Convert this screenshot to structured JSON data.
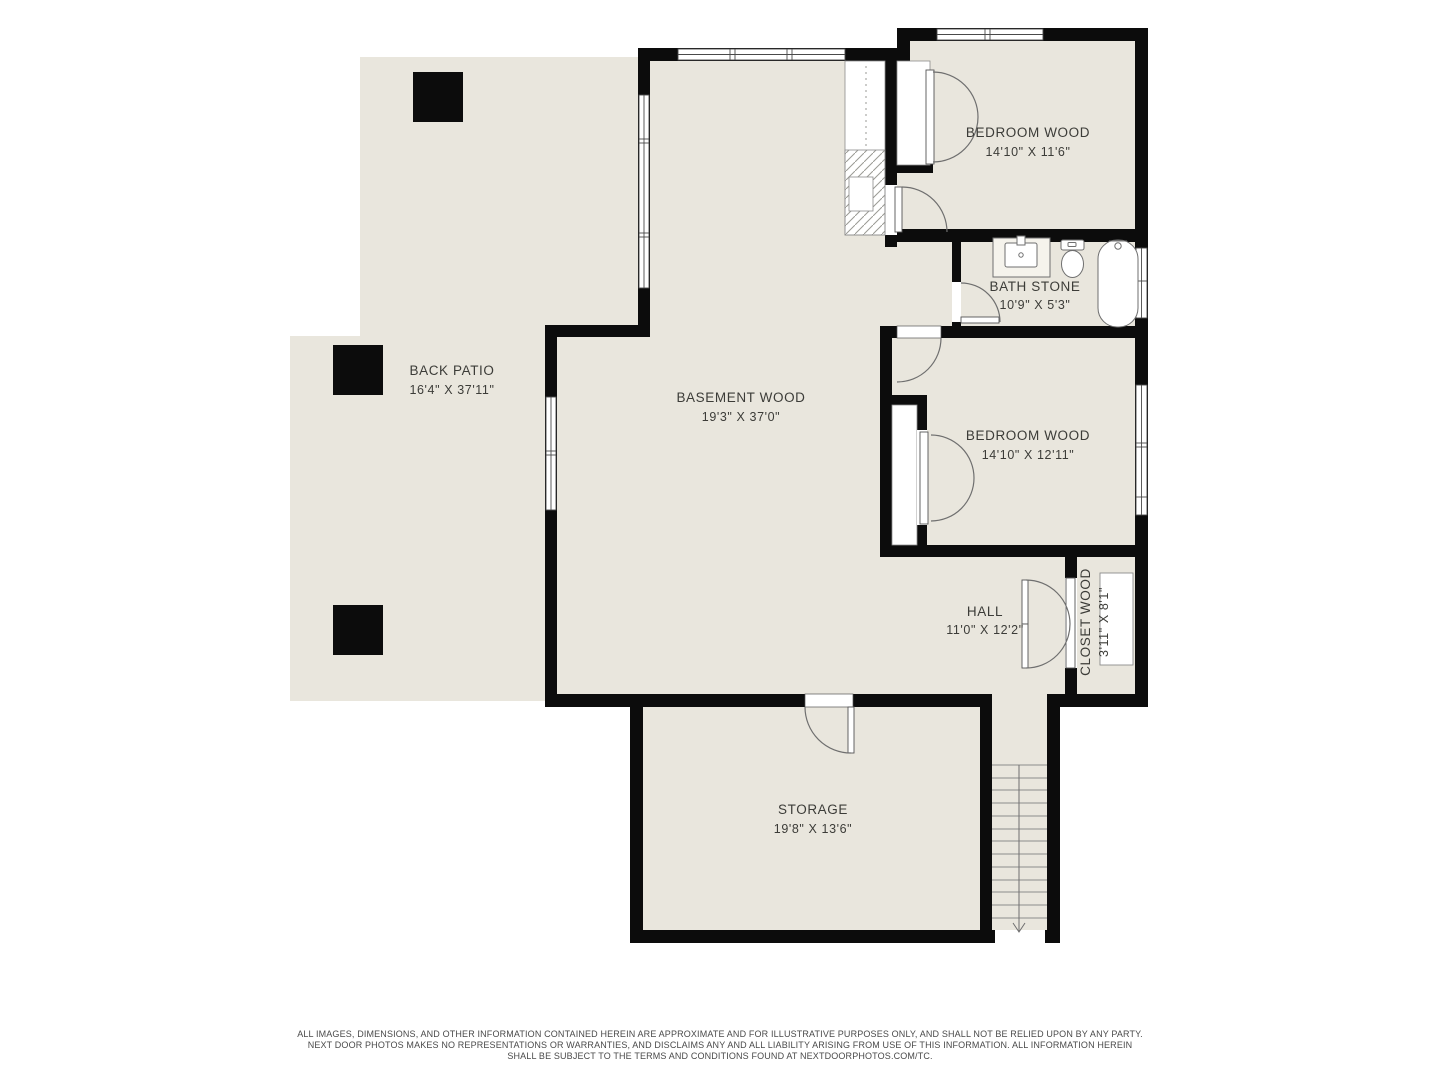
{
  "floorplan": {
    "title": "Basement floor plan",
    "rooms": [
      {
        "id": "back-patio",
        "name": "BACK PATIO",
        "dims": "16'4\" X 37'11\""
      },
      {
        "id": "basement",
        "name": "BASEMENT WOOD",
        "dims": "19'3\" X 37'0\""
      },
      {
        "id": "bedroom-top",
        "name": "BEDROOM WOOD",
        "dims": "14'10\" X 11'6\""
      },
      {
        "id": "bath",
        "name": "BATH STONE",
        "dims": "10'9\" X 5'3\""
      },
      {
        "id": "bedroom-right",
        "name": "BEDROOM WOOD",
        "dims": "14'10\" X 12'11\""
      },
      {
        "id": "hall",
        "name": "HALL",
        "dims": "11'0\" X 12'2\""
      },
      {
        "id": "closet",
        "name": "CLOSET WOOD",
        "dims": "3'11\" X 8'1\""
      },
      {
        "id": "storage",
        "name": "STORAGE",
        "dims": "19'8\" X 13'6\""
      }
    ],
    "stairs": {
      "direction": "down"
    },
    "colors": {
      "floor": "#e9e6dd",
      "wall": "#0c0c0c",
      "background": "#ffffff",
      "fixture_line": "#6f6f6f"
    }
  },
  "footer": {
    "lines": [
      "ALL IMAGES, DIMENSIONS, AND OTHER INFORMATION CONTAINED HEREIN ARE APPROXIMATE AND FOR ILLUSTRATIVE PURPOSES ONLY, AND SHALL NOT BE RELIED UPON BY ANY PARTY.",
      "NEXT DOOR PHOTOS MAKES NO REPRESENTATIONS OR WARRANTIES, AND DISCLAIMS ANY AND ALL LIABILITY ARISING FROM USE OF THIS INFORMATION. ALL INFORMATION HEREIN",
      "SHALL BE SUBJECT TO THE TERMS AND CONDITIONS FOUND AT NEXTDOORPHOTOS.COM/TC."
    ]
  }
}
